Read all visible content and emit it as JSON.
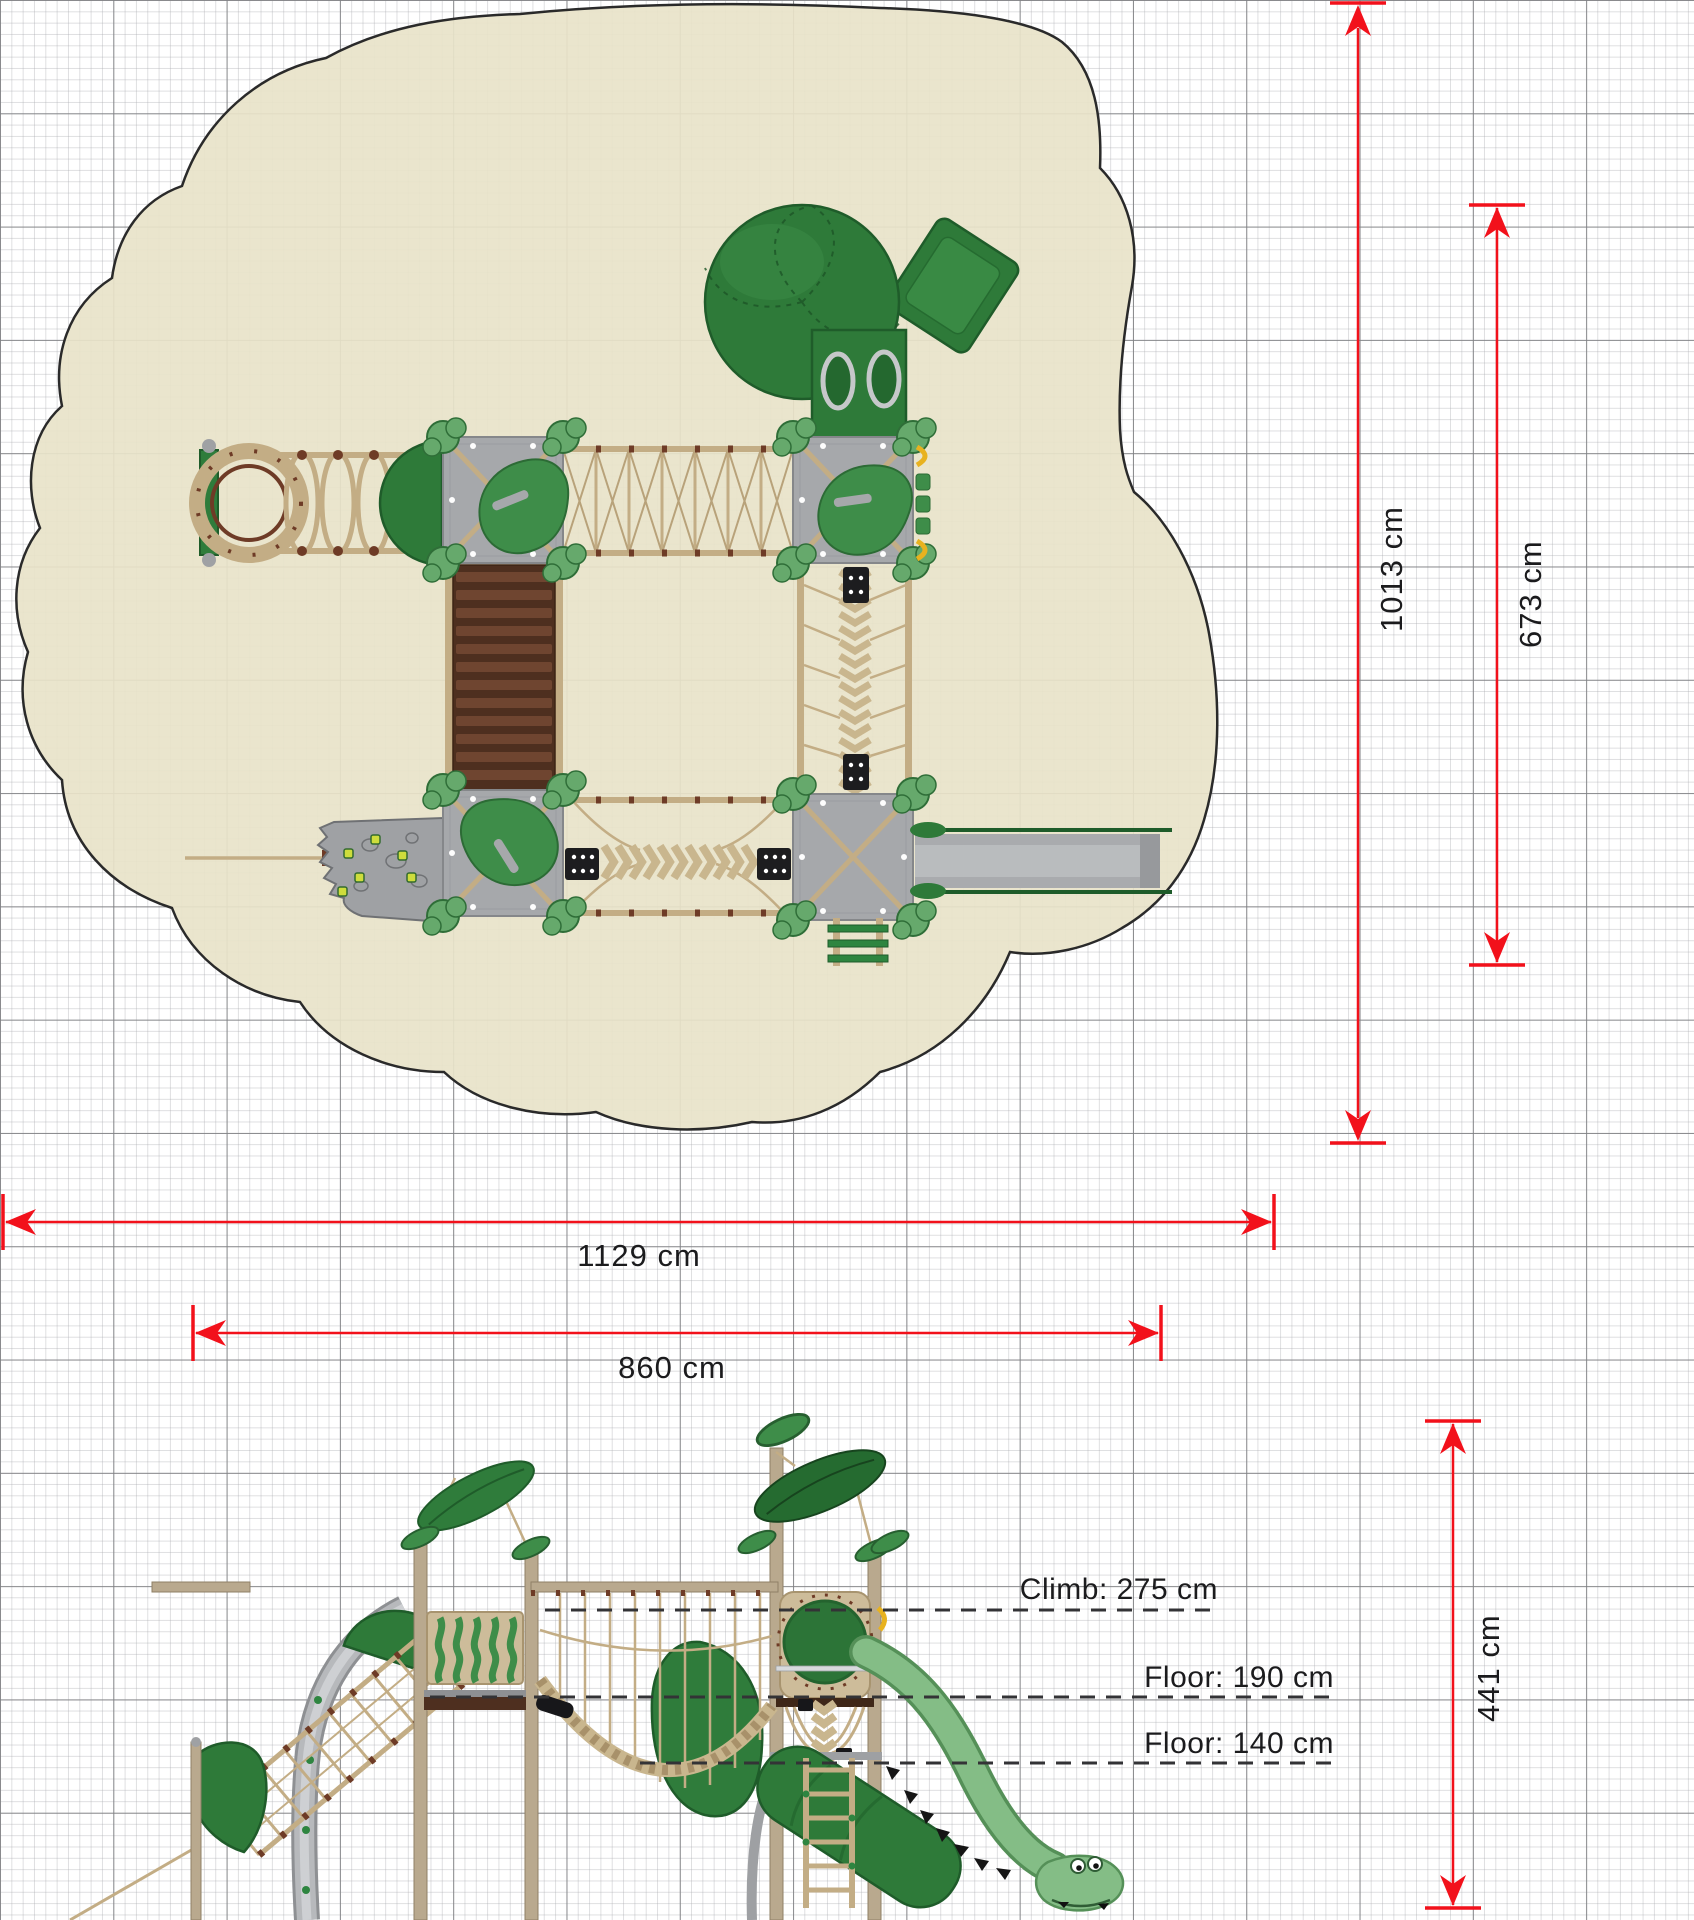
{
  "drawing": {
    "kind": "playground equipment technical drawing (plan and elevation on grid)",
    "dimensions": {
      "height_total": "1013 cm",
      "height_inner": "673 cm",
      "width_total": "1129 cm",
      "width_inner": "860 cm",
      "side_height": "441 cm"
    },
    "annotations": {
      "climb": "Climb: 275 cm",
      "floor_upper": "Floor: 190 cm",
      "floor_lower": "Floor: 140 cm"
    },
    "colors": {
      "dimension_red": "#f2111b",
      "surface_beige": "#e8e3c9",
      "equipment_green": "#2e7a39",
      "leaf_green": "#66a96c",
      "rope_tan": "#c3ad85",
      "knot_brown": "#6e3b26",
      "deck_gray": "#a6a8ab",
      "stair_brown": "#5c3826",
      "slide_gray": "#a9abae",
      "dino_green": "#84bd86"
    }
  }
}
